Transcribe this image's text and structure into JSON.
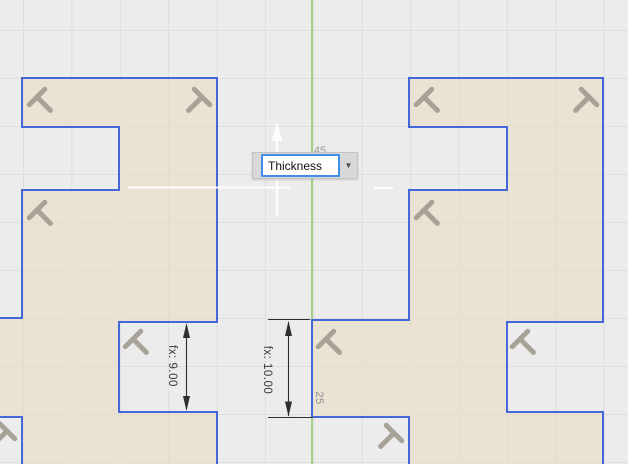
{
  "app": {
    "context": "sketch-canvas"
  },
  "input_popup": {
    "value": "Thickness",
    "dropdown_icon": "▼"
  },
  "dimensions": {
    "slot_dim": "fx: 9.00",
    "tab_dim": "fx: 10.00",
    "tab_label": "25",
    "occluded_value": "45"
  },
  "colors": {
    "sketch_line": "#4468db",
    "profile_fill": "#e9dcc3",
    "axis_green": "#8ccf6e",
    "constraint_icon": "#9b9388",
    "dim_line": "#2f2f2f",
    "input_border": "#3f8fe8",
    "popup_bg": "#d8d8d8",
    "canvas_bg": "#ececec"
  }
}
